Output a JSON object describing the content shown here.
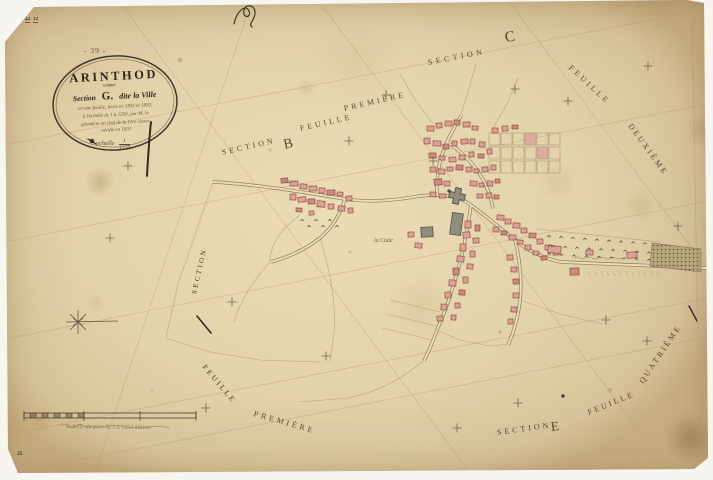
{
  "colors": {
    "paper": "#e3d3ae",
    "ink": "#3c3322",
    "building_red": "#dea193",
    "building_stroke": "#7a4236",
    "church_gray": "#908d80",
    "faint_line": "#a8905f"
  },
  "sheet": {
    "page_number": "- 39 -",
    "stamp_top_left_a": "22",
    "stamp_top_left_b": "12",
    "stamp_bottom_left": "25"
  },
  "cartouche": {
    "commune": "ARINTHOD",
    "section_prefix": "Section",
    "section_letter": "G.",
    "section_superscript": "unique",
    "section_suffix": "dite la Ville",
    "hand_lines": [
      "en une feuille, levée en 1832 et 1833,",
      "à l'échelle de 1 à 1250, par M. le",
      "géomètre en chef de la 1ère classe,",
      "vérifié en 1833"
    ],
    "scale_word": "echelle",
    "scale_numerator": "1",
    "scale_denominator": "1250"
  },
  "section_labels": {
    "b": {
      "section": "SECTION",
      "letter": "B",
      "feuille": "FEUILLE",
      "premiere": "PREMIÈRE"
    },
    "c": {
      "section": "SECTION",
      "letter": "C"
    },
    "right": {
      "feuille": "FEUILLE",
      "deuxieme": "DEUXIÈME"
    },
    "south_east": {
      "quatrieme": "QUATRIÈME",
      "feuille": "FEUILLE",
      "section": "SECTION",
      "letter": "E"
    },
    "left": {
      "section": "SECTION",
      "feuille": "FEUILLE",
      "premiere": "PREMIÈRE"
    }
  },
  "place_labels": {
    "hamlet": "la Cude"
  },
  "scale_bar": {
    "caption": "Echelle du plan de 1 à 1250 Mètres"
  }
}
